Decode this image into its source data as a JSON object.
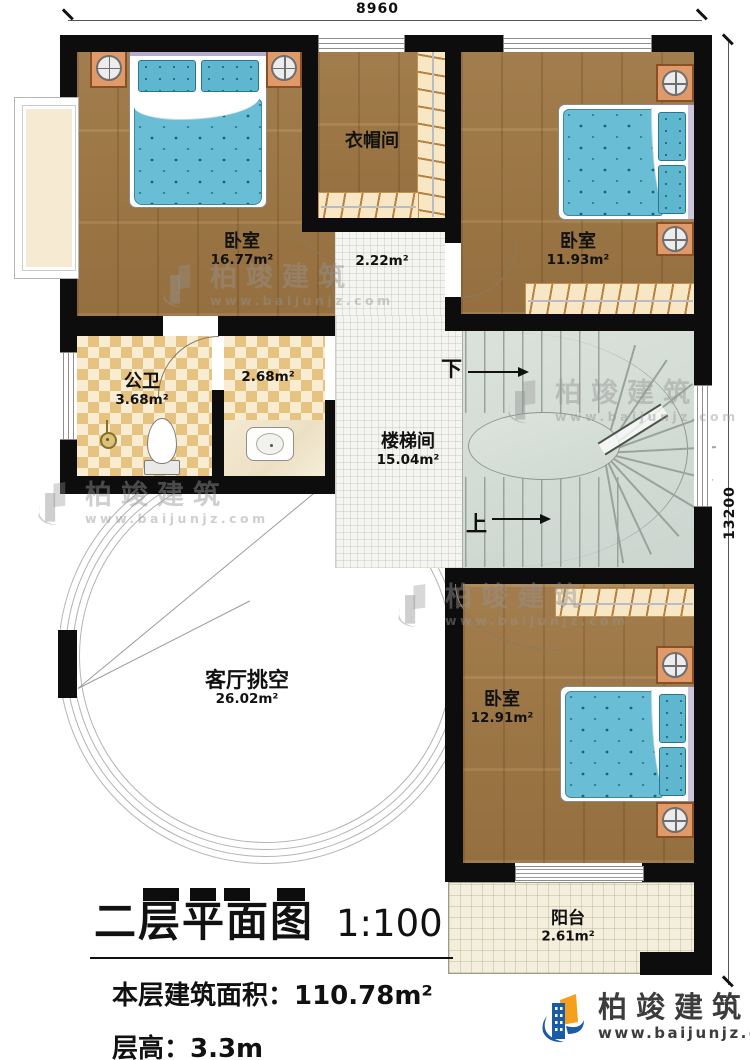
{
  "dimensions": {
    "top": "8960",
    "right": "13200"
  },
  "rooms": {
    "bedroom1": {
      "name": "卧室",
      "area": "16.77m²"
    },
    "cloakroom": {
      "name": "衣帽间"
    },
    "bedroom2": {
      "name": "卧室",
      "area": "11.93m²"
    },
    "hallway": {
      "area": "2.22m²"
    },
    "bathroom": {
      "name": "公卫",
      "area": "3.68m²"
    },
    "washroom": {
      "area": "2.68m²"
    },
    "stairwell": {
      "name": "楼梯间",
      "area": "15.04m²"
    },
    "living_void": {
      "name": "客厅挑空",
      "area": "26.02m²"
    },
    "bedroom3": {
      "name": "卧室",
      "area": "12.91m²"
    },
    "balcony": {
      "name": "阳台",
      "area": "2.61m²"
    }
  },
  "stairs": {
    "down": "下",
    "up": "上"
  },
  "title_block": {
    "title": "二层平面图",
    "scale": "1:100",
    "floor_area": "本层建筑面积：110.78m²",
    "floor_height": "层高：3.3m"
  },
  "watermark": {
    "brand": "柏竣建筑",
    "url": "www.baijunjz.com"
  },
  "logo": {
    "brand": "柏竣建筑",
    "url": "www.baijunjz.com"
  },
  "colors": {
    "wall": "#0d0d0d",
    "wood_floor": "#a67c46",
    "checker_tile": "#e7c382",
    "white_tile": "#f4f4f1",
    "stair_gray": "#d3dbd5",
    "bed_teal": "#69bed5",
    "nightstand_orange": "#e09a6a",
    "balcony_tile": "#f3efdc",
    "logo_blue": "#1a5ba8",
    "logo_orange": "#f5a01c"
  }
}
